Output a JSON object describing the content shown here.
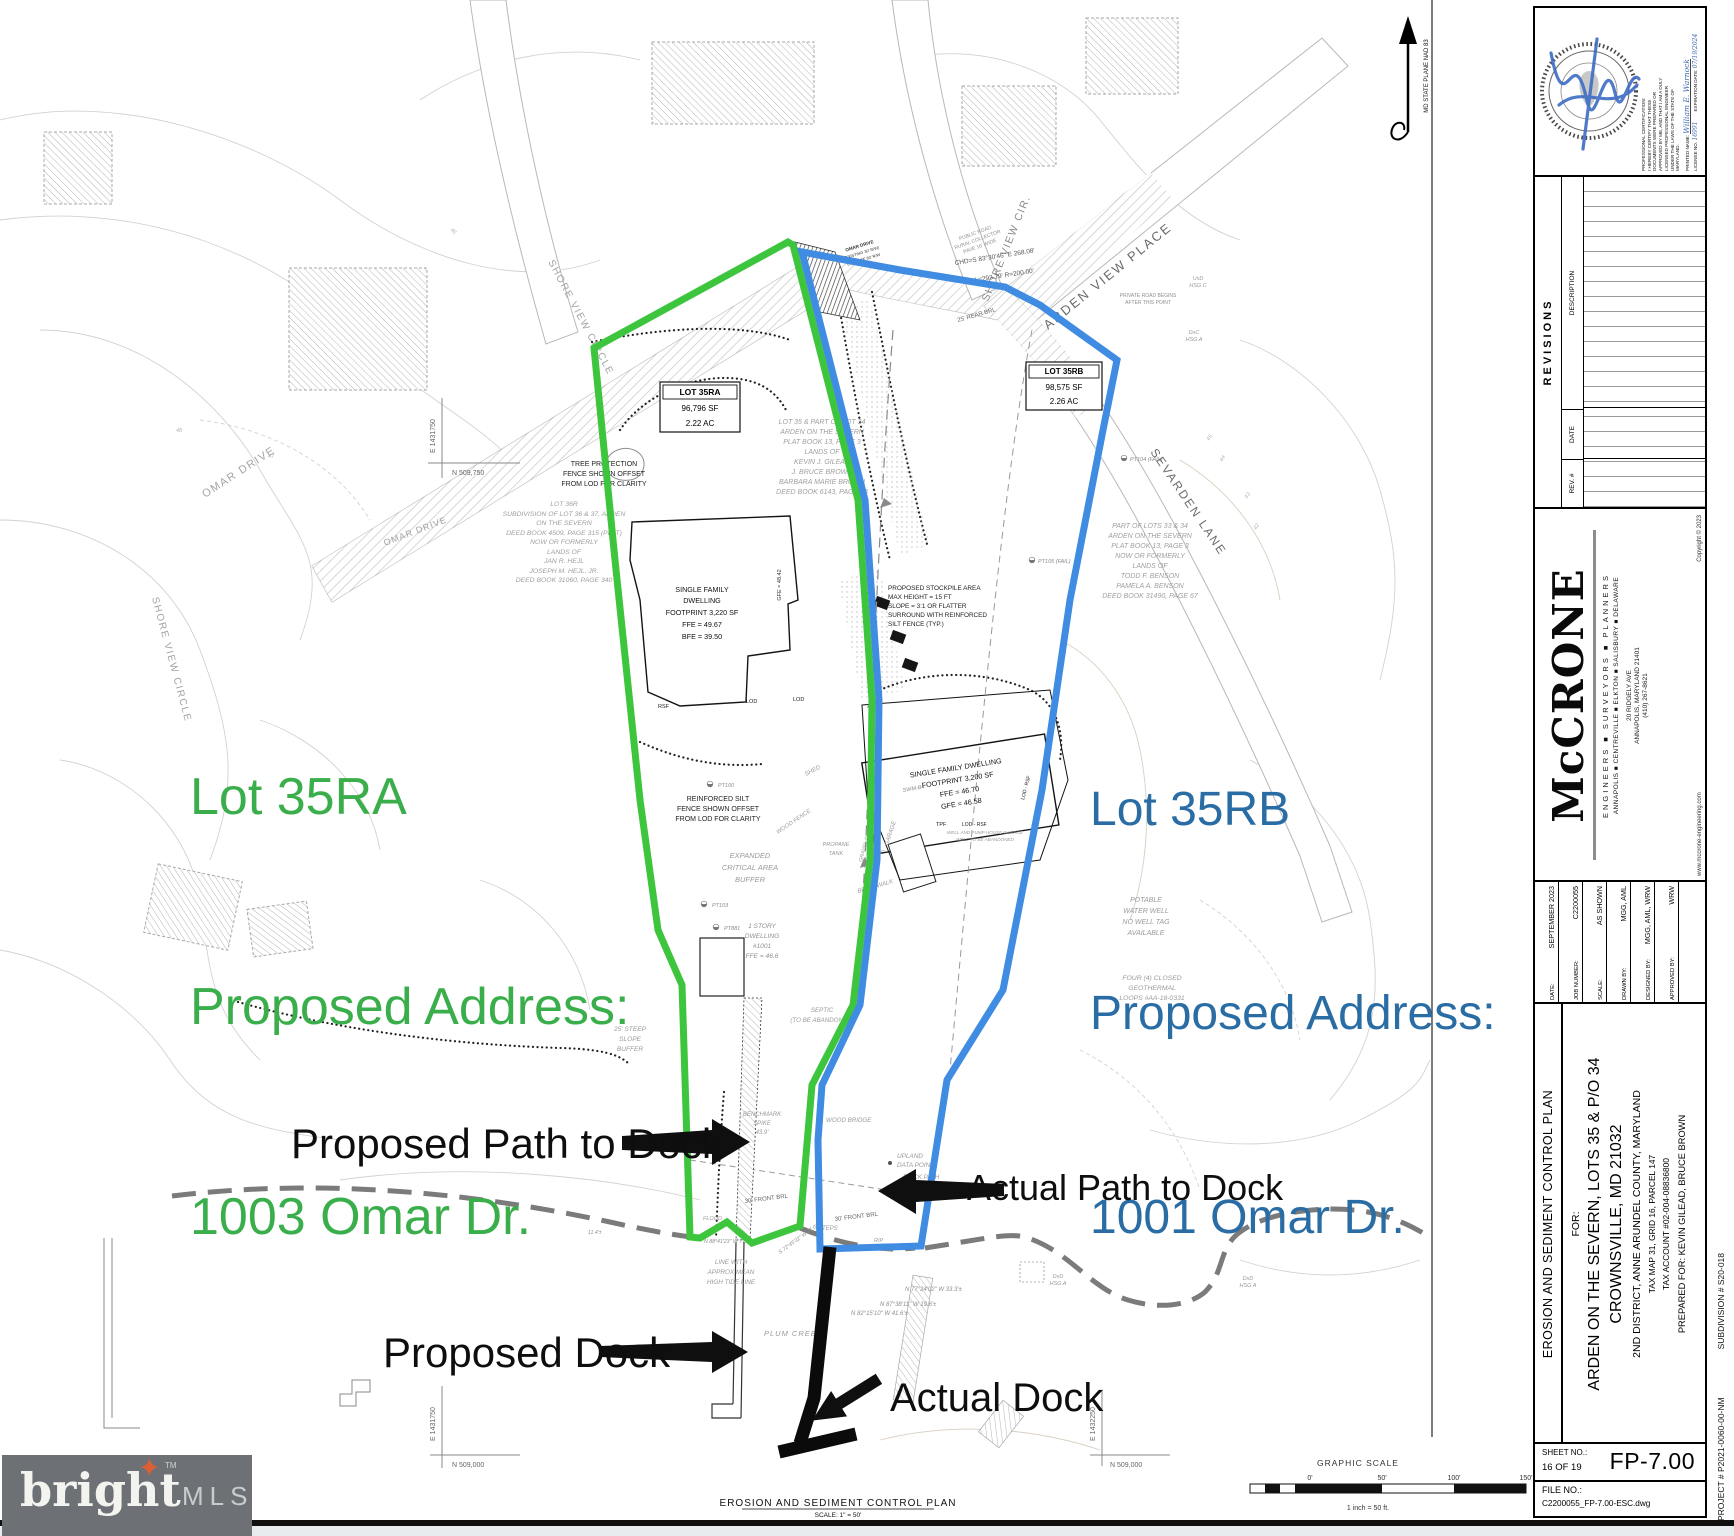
{
  "annotations": {
    "lot_a_1": "Lot 35RA",
    "lot_a_2": "Proposed Address:",
    "lot_a_3": "1003 Omar Dr.",
    "lot_b_1": "Lot 35RB",
    "lot_b_2": "Proposed Address:",
    "lot_b_3": "1001 Omar Dr.",
    "proposed_path": "Proposed Path to Dock",
    "actual_path": "Actual Path to Dock",
    "proposed_dock": "Proposed Dock",
    "actual_dock": "Actual Dock",
    "green": "#3aae4a",
    "blue": "#2a6da5"
  },
  "map": {
    "roads": {
      "omar1": "OMAR DRIVE",
      "omar2": "OMAR DRIVE",
      "omar_s1": "OMAR DRIVE",
      "omar_s2": "(EXISTING 30' R/W)",
      "omar_s3": "ULTIMATE 60' R/W",
      "shore1": "SHORE VIEW CIRCLE",
      "shore2": "SHORE VIEW CIRCLE",
      "shore3": "SHORE VIEW CIR.",
      "arden": "ARDEN VIEW PLACE",
      "sevarden": "SEVARDEN LANE",
      "public1": "PUBLIC ROAD",
      "public2": "RURAL COLLECTOR",
      "public3": "PAVE 16' WIDE",
      "private1": "PRIVATE ROAD BEGINS",
      "private2": "AFTER THIS POINT",
      "chd": "CHD=S 83°30'46\" E  268.08'",
      "arc": "L=293.79'  R=200.00'",
      "rear_brl": "25' REAR BRL",
      "front_brl1": "30' FRONT BRL",
      "front_brl2": "30' FRONT BRL"
    },
    "lotbox_a": {
      "l1": "LOT 35RA",
      "l2": "96,796 SF",
      "l3": "2.22 AC"
    },
    "lotbox_b": {
      "l1": "LOT 35RB",
      "l2": "98,575 SF",
      "l3": "2.26 AC"
    },
    "parcels": {
      "lot36r": [
        "LOT 36R",
        "SUBDIVISION OF LOT 36 & 37, ARDEN",
        "ON THE SEVERN",
        "DEED BOOK 4509, PAGE 315 (PLAT)",
        "NOW OR FORMERLY",
        "LANDS OF",
        "JAN R. HEJL",
        "JOSEPH M. HEJL, JR.",
        "DEED BOOK 31060, PAGE 340"
      ],
      "gilead": [
        "LOT 35 & PART OF LOT 34",
        "ARDEN ON THE SEVERN",
        "PLAT BOOK 13, PAGE 3",
        "LANDS OF",
        "KEVIN J. GILEAD",
        "J. BRUCE BROWN",
        "BARBARA MARIE BROWN",
        "DEED BOOK 6143, PAGE 23"
      ],
      "benson": [
        "PART OF LOTS 33 & 34",
        "ARDEN ON THE SEVERN",
        "PLAT BOOK 13, PAGE 3",
        "NOW OR FORMERLY",
        "LANDS OF",
        "TODD F. BENSON",
        "PAMELA A. BENSON",
        "DEED BOOK 31490, PAGE 67"
      ]
    },
    "dwell_a": [
      "SINGLE FAMILY",
      "DWELLING",
      "FOOTPRINT 3,220 SF",
      "FFE = 49.67",
      "BFE = 39.50"
    ],
    "dwell_a_gfe": "GFE = 48.42",
    "dwell_b": [
      "SINGLE FAMILY DWELLING",
      "FOOTPRINT 3,200 SF",
      "FFE = 46.70",
      "GFE = 46.58"
    ],
    "dwell_c": [
      "1 STORY",
      "DWELLING",
      "#1001",
      "FFE = 46.6"
    ],
    "notes": {
      "tree1": "TREE PROTECTION",
      "tree2": "FENCE SHOWN OFFSET",
      "tree3": "FROM LOD FOR CLARITY",
      "silt1": "REINFORCED SILT",
      "silt2": "FENCE SHOWN OFFSET",
      "silt3": "FROM LOD FOR CLARITY",
      "stock1": "PROPOSED STOCKPILE AREA",
      "stock2": "MAX HEIGHT = 15 FT",
      "stock3": "SLOPE = 3:1 OR FLATTER",
      "stock4": "SURROUND WITH REINFORCED",
      "stock5": "SILT FENCE (TYP.)",
      "buf1": "EXPANDED",
      "buf2": "CRITICAL AREA",
      "buf3": "BUFFER",
      "steep1": "25' STEEP",
      "steep2": "SLOPE",
      "steep3": "BUFFER",
      "pot1": "POTABLE",
      "pot2": "WATER WELL",
      "pot3": "NO WELL TAG",
      "pot4": "AVAILABLE",
      "geo1": "FOUR (4) CLOSED",
      "geo2": "GEOTHERMAL",
      "geo3": "LOOPS #AA-18-0331",
      "tide1": "LINE WITH",
      "tide2": "APPROX MEAN",
      "tide3": "HIGH TIDE LINE",
      "plum": "PLUM CREEK",
      "bench1": "BENCHMARK",
      "bench2": "SPIKE",
      "bench3": "43.9'",
      "upland1": "UPLAND",
      "upland2": "DATA POINT",
      "brickpath": "BRICK PATH",
      "woodbridge": "WOOD BRIDGE",
      "steps": "STEPS",
      "rip": "RIP",
      "shed": "SHED",
      "garage": "GARAGE",
      "woodfence": "WOOD FENCE",
      "brickwalk": "BRICK WALK",
      "prop1": "PROPANE",
      "prop2": "TANK",
      "sep1": "SEPTIC",
      "sep2": "(TO BE ABANDONED)",
      "flood": "FLOOD",
      "well1": "WELL AND PUMP HOUSE GARAGE",
      "well2": "WELL TO BE ABANDONED",
      "gravel": "GRAVEL DRIVEWAY"
    },
    "soils": {
      "s1a": "UxD",
      "s1b": "HSG C",
      "s2a": "DxC",
      "s2b": "HSG A",
      "s3a": "DvD",
      "s3b": "HSG A",
      "s4a": "DxD",
      "s4b": "HSG A"
    },
    "pts": {
      "pt100": "PT100",
      "pt103": "PT103",
      "pt881": "PT881",
      "ptc": "PT C",
      "pt104": "PT104 (FAIL)",
      "pt105": "PT105 (FAIL)",
      "swm": "SWM-B4"
    },
    "lod": {
      "a": "LOD",
      "b": "LOD",
      "c": "RSF",
      "d": "TPF",
      "e": "LOD - RSF",
      "f": "LOD - RSF"
    },
    "bearings": {
      "b1": "N 77°24'02\" W  33.3'±",
      "b2": "N 87°38'11\" W  19.6'±",
      "b3": "N 82°15'10\" W  41.6'±",
      "b4": "N 88°41'23\" W  77.4'±",
      "b5": "S 72°45'32\" W  27.0'±",
      "b6": "11.4'±"
    },
    "elev": {
      "e1": "46",
      "e2": "47",
      "e3": "48",
      "e4": "45",
      "e5": "44",
      "e6": "43",
      "e7": "42"
    },
    "coords": {
      "nw_e": "E 1431750",
      "nw_n": "N 509,750",
      "sw_e": "E 1431750",
      "sw_n": "N 509,000",
      "se_e": "E 1432250",
      "se_n": "N 509,000"
    },
    "plan": {
      "title": "EROSION AND SEDIMENT CONTROL PLAN",
      "scale": "SCALE: 1\" = 50'"
    },
    "gscale": {
      "title": "GRAPHIC SCALE",
      "t0": "0'",
      "t1": "50'",
      "t2": "100'",
      "t3": "150'",
      "note": "1 inch =  50 ft."
    }
  },
  "title_block": {
    "north_label": "MD STATE PLANE NAD 83",
    "seal": {
      "cert": [
        "PROFESSIONAL CERTIFICATION:",
        "I HEREBY CERTIFY THAT THESE",
        "DOCUMENTS WERE PREPARED OR",
        "APPROVED BY ME, AND THAT I AM A DULY",
        "LICENSED PROFESSIONAL ENGINEER",
        "UNDER THE LAWS OF THE STATE OF",
        "MARYLAND."
      ],
      "pn_label": "PRINTED NAME:",
      "pn": "William E. Warnock",
      "lic_label": "LICENSE NO.",
      "lic": "16991",
      "exp_label": "EXPIRATION DATE:",
      "exp": "07/19/2024"
    },
    "revisions": {
      "title": "REVISIONS",
      "desc": "DESCRIPTION",
      "date": "DATE",
      "rev": "REV. #"
    },
    "firm": {
      "name": "McCRONE",
      "tag1": "ENGINEERS  ■  SURVEYORS  ■  PLANNERS",
      "tag2": "ANNAPOLIS ■ CENTREVILLE ■ ELKTON ■ SALISBURY ■ DELAWARE",
      "addr1": "20 RIDGELY AVE",
      "addr2": "ANNAPOLIS, MARYLAND 21401",
      "addr3": "(410) 267-8621",
      "web": "www.mccrone-engineering.com",
      "copy": "Copyright © 2023"
    },
    "info": [
      {
        "label": "DATE:",
        "value": "SEPTEMBER 2023"
      },
      {
        "label": "JOB NUMBER:",
        "value": "C2200055"
      },
      {
        "label": "SCALE:",
        "value": "AS SHOWN"
      },
      {
        "label": "DRAWN BY:",
        "value": "MGG, AML"
      },
      {
        "label": "DESIGNED BY:",
        "value": "MGG, AML, WRW"
      },
      {
        "label": "APPROVED BY:",
        "value": "WRW"
      }
    ],
    "project": {
      "plan": "EROSION AND SEDIMENT CONTROL PLAN",
      "for_label": "FOR:",
      "name1": "ARDEN ON THE SEVERN, LOTS 35 & P/O 34",
      "name2": "CROWNSVILLE, MD 21032",
      "line3": "2ND DISTRICT, ANNE ARUNDEL COUNTY, MARYLAND",
      "line4": "TAX MAP 31, GRID 16, PARCEL 147",
      "line5": "TAX ACCOUNT #02-004-08836800",
      "line6": "PREPARED FOR: KEVIN GILEAD, BRUCE BROWN"
    },
    "sheet": {
      "label": "SHEET NO.:",
      "pages": "16 OF 19",
      "number": "FP-7.00",
      "file_label": "FILE NO.:",
      "file": "C2200055_FP-7.00-ESC.dwg"
    },
    "edge": {
      "project_no": "PROJECT # P2021-0060-00-NM",
      "subdivision": "SUBDIVISION # S20-018"
    }
  },
  "logo": {
    "word": "bright",
    "tm": "TM",
    "mls": "MLS"
  }
}
